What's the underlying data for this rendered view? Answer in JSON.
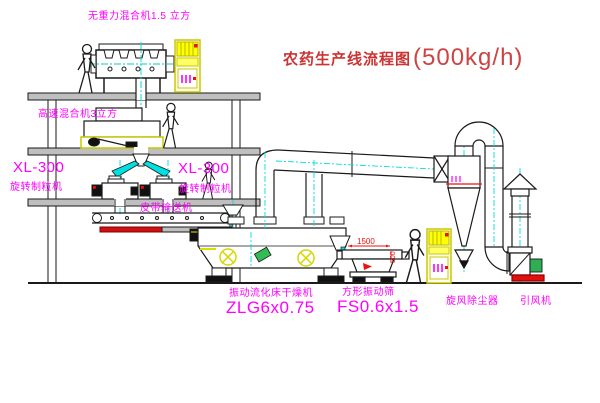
{
  "title": {
    "text": "农药生产线流程图",
    "capacity": "(500kg/h)"
  },
  "colors": {
    "label_magenta": "#ff00ff",
    "title_red": "#cc3333",
    "centerline_cyan": "#00e0e0",
    "cabinet_yellow": "#ffff00",
    "dimension_red": "#ee1111",
    "line_black": "#1a1a1a"
  },
  "equipment": {
    "gravity_mixer": {
      "label": "无重力混合机1.5 立方"
    },
    "high_speed_mixer": {
      "label": "高速混合机3立方"
    },
    "granulator_left": {
      "model": "XL-300",
      "name": "旋转制粒机"
    },
    "granulator_right": {
      "model": "XL-300",
      "name": "旋转制粒机"
    },
    "belt_conveyor": {
      "name": "皮带输送机"
    },
    "fluid_bed_dryer": {
      "name": "振动流化床干燥机",
      "model": "ZLG6x0.75"
    },
    "vibrating_sieve": {
      "name": "方形振动筛",
      "model": "FS0.6x1.5",
      "dim_length": "1500",
      "dim_height": "500"
    },
    "cyclone": {
      "name": "旋风除尘器"
    },
    "fan": {
      "name": "引风机"
    }
  }
}
